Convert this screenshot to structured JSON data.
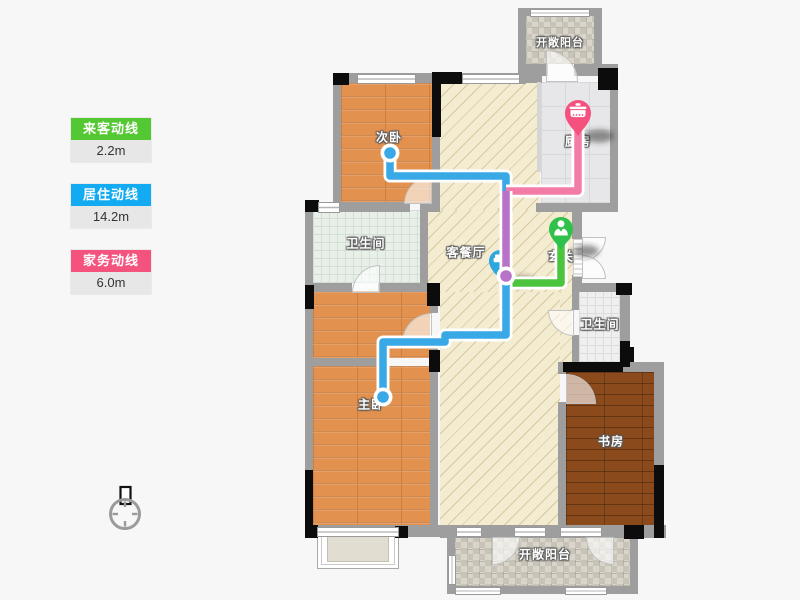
{
  "legend": {
    "items": [
      {
        "label": "来客动线",
        "value": "2.2m",
        "color": "#54c832"
      },
      {
        "label": "居住动线",
        "value": "14.2m",
        "color": "#12aaf0"
      },
      {
        "label": "家务动线",
        "value": "6.0m",
        "color": "#f4537e"
      }
    ]
  },
  "rooms": {
    "balcony_top": "开敞阳台",
    "kitchen": "厨房",
    "secondary_bedroom": "次卧",
    "bathroom_left": "卫生间",
    "living_dining": "客餐厅",
    "entrance": "玄关",
    "bathroom_right": "卫生间",
    "master_bedroom": "主卧",
    "study": "书房",
    "balcony_bottom": "开敞阳台"
  },
  "pins": {
    "kitchen_pin_icon": "pot-icon",
    "entrance_pin_icon": "person-icon",
    "living_pin_icon": "sofa-icon"
  },
  "route_colors": {
    "visitor": "#4cc43e",
    "living": "#38a9e6",
    "housework": "#f37ca7",
    "overlap": "#b873c9"
  }
}
